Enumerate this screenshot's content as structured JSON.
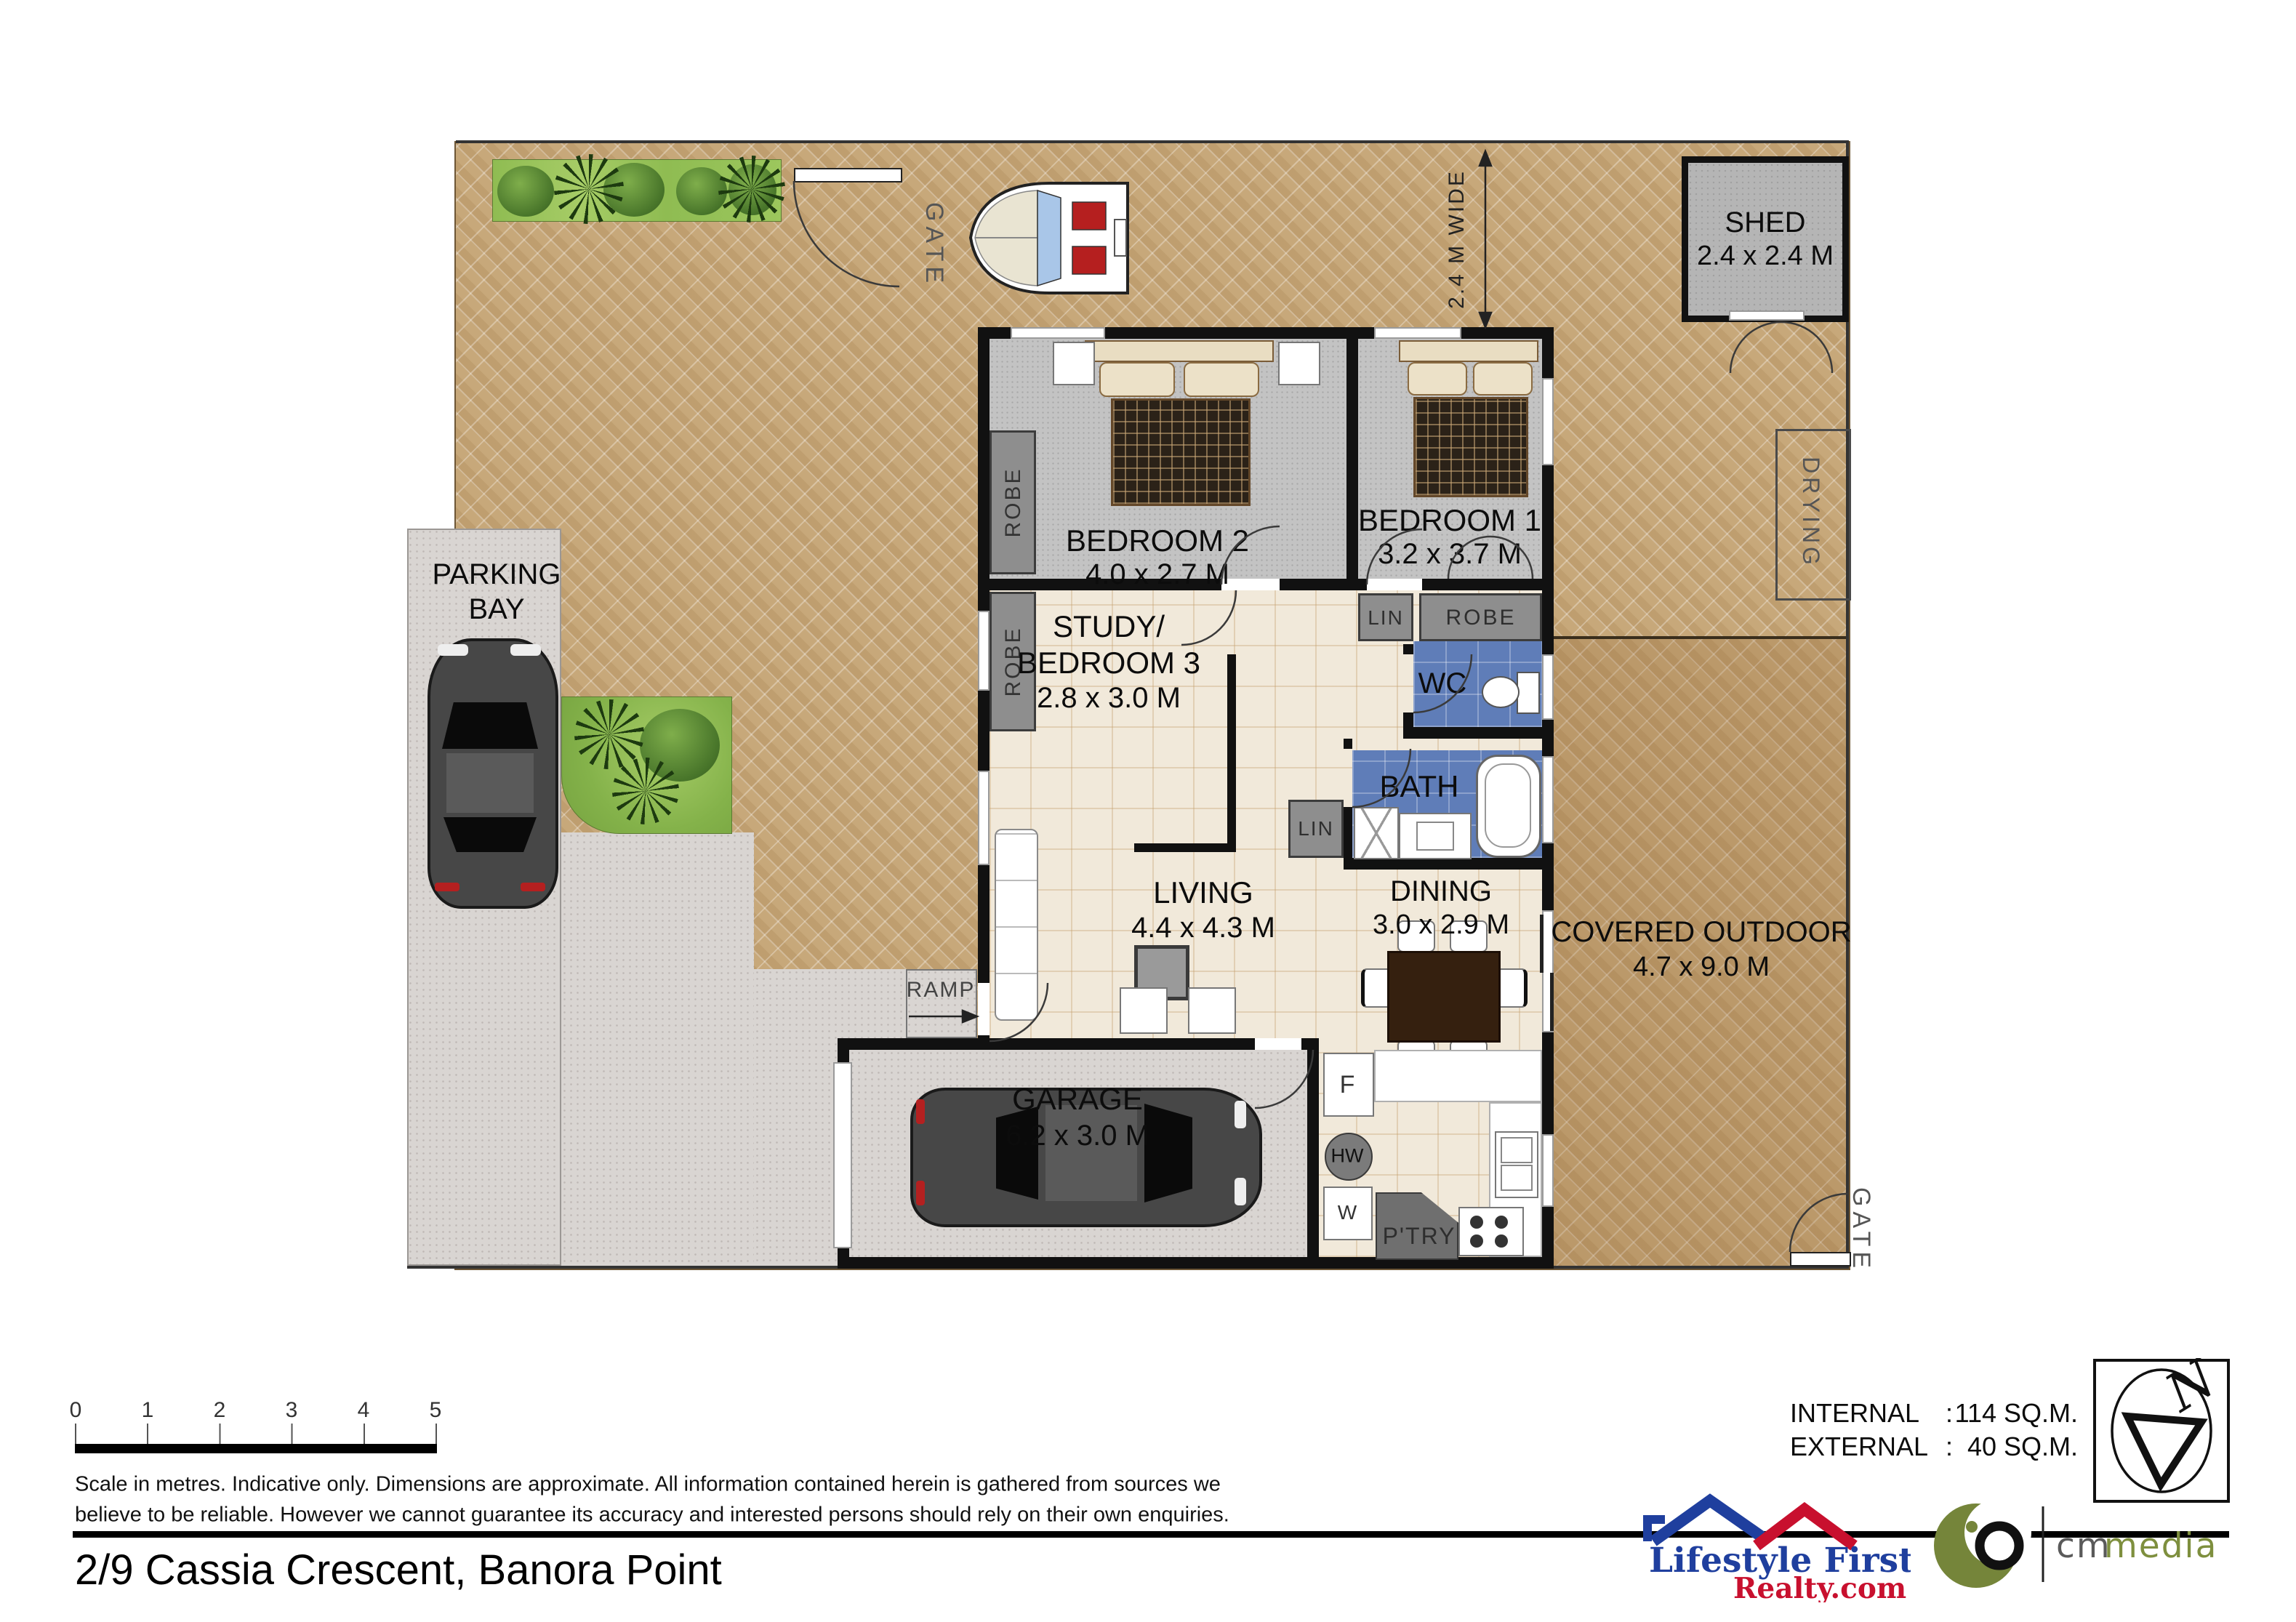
{
  "colors": {
    "wall": "#111111",
    "pavement": "#c7a87a",
    "concrete": "#d9d5d2",
    "tile": "#f1e9da",
    "carpet": "#c3c3c3",
    "wet_room": "#5f7db8",
    "closet": "#8e8e8e",
    "garden": "#7fb643",
    "shed": "#b5b5b5",
    "logo_blue": "#1f3f9e",
    "logo_red": "#c8102e",
    "logo_olive": "#75853a"
  },
  "plan": {
    "rooms": {
      "bedroom2": {
        "name": "BEDROOM 2",
        "dims": "4.0 x 2.7 M"
      },
      "bedroom1": {
        "name": "BEDROOM 1",
        "dims": "3.2 x 3.7 M"
      },
      "study": {
        "name_line1": "STUDY/",
        "name_line2": "BEDROOM 3",
        "dims": "2.8 x 3.0 M"
      },
      "living": {
        "name": "LIVING",
        "dims": "4.4 x 4.3 M"
      },
      "dining": {
        "name": "DINING",
        "dims": "3.0 x 2.9 M"
      },
      "garage": {
        "name": "GARAGE",
        "dims": "6.2 x 3.0 M"
      },
      "shed": {
        "name": "SHED",
        "dims": "2.4 x 2.4 M"
      },
      "covered_outdoor": {
        "name": "COVERED OUTDOOR",
        "dims": "4.7 x 9.0 M"
      },
      "parking_bay": {
        "name_line1": "PARKING",
        "name_line2": "BAY"
      },
      "wc": {
        "name": "WC"
      },
      "bath": {
        "name": "BATH"
      }
    },
    "fixtures": {
      "robe": "ROBE",
      "linen": "LIN",
      "pantry": "P'TRY",
      "fridge": "F",
      "hot_water": "HW",
      "washer": "W"
    },
    "site": {
      "gate": "GATE",
      "drying": "DRYING",
      "ramp": "RAMP",
      "side_width": "2.4 M WIDE"
    }
  },
  "scale_bar": {
    "ticks": [
      "0",
      "1",
      "2",
      "3",
      "4",
      "5"
    ],
    "note_line1": "Scale in metres.  Indicative only.  Dimensions are approximate.  All information contained herein is gathered from sources we",
    "note_line2": "believe to be reliable.  However we cannot guarantee its accuracy and interested persons should rely on their own enquiries."
  },
  "areas": {
    "internal_label": "INTERNAL",
    "separator": ":",
    "internal_value": "114 SQ.M.",
    "external_label": "EXTERNAL",
    "external_value": "40 SQ.M."
  },
  "title": {
    "address": "2/9 Cassia Crescent, Banora Point"
  },
  "compass": {
    "north": "N"
  },
  "branding": {
    "realty_name": "Lifestyle First",
    "realty_domain": "Realty.com",
    "media_prefix": "cm",
    "media_suffix": "media"
  }
}
